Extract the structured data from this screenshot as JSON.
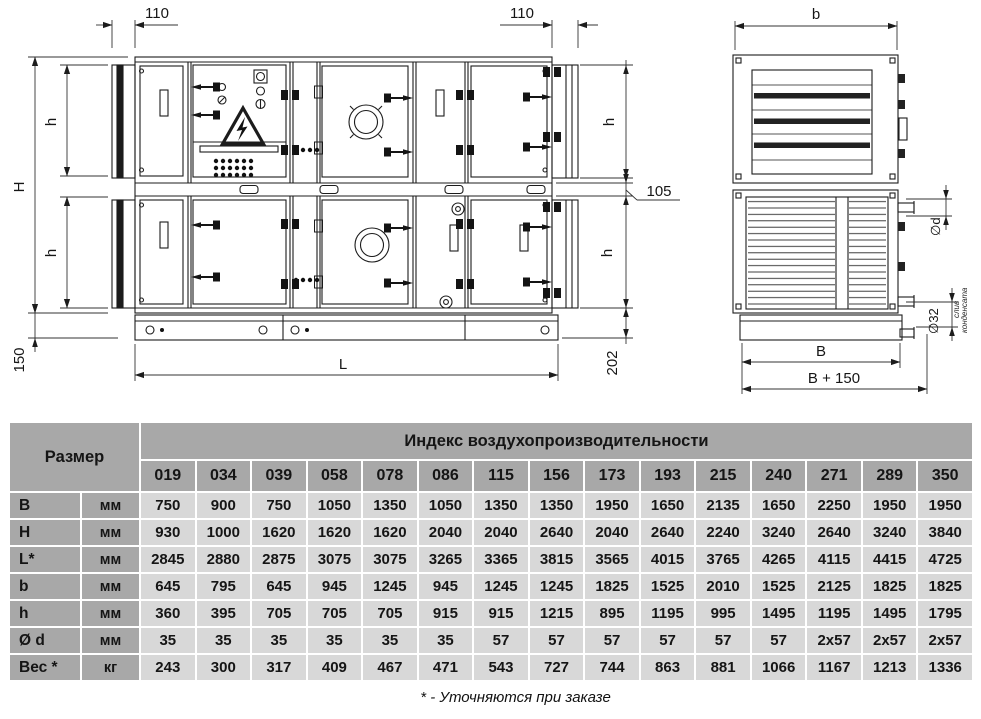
{
  "drawing": {
    "front": {
      "dim_collar_left": "110",
      "dim_collar_right": "110",
      "dim_height": "H",
      "dim_h_upper_left": "h",
      "dim_h_lower_left": "h",
      "dim_h_upper_right": "h",
      "dim_h_lower_right": "h",
      "dim_base_height": "150",
      "dim_length": "L",
      "dim_right_base": "202",
      "dim_mid_frame": "105"
    },
    "side": {
      "dim_top_width": "b",
      "dim_width": "B",
      "dim_width_total": "B + 150",
      "dim_pipe": "∅d",
      "dim_drain": "∅32",
      "drain_caption_line1": "слив",
      "drain_caption_line2": "конденсата"
    }
  },
  "table": {
    "size_header": "Размер",
    "index_header": "Индекс воздухопроизводительности",
    "columns": [
      "019",
      "034",
      "039",
      "058",
      "078",
      "086",
      "115",
      "156",
      "173",
      "193",
      "215",
      "240",
      "271",
      "289",
      "350"
    ],
    "rows": [
      {
        "label": "B",
        "unit": "мм",
        "values": [
          "750",
          "900",
          "750",
          "1050",
          "1350",
          "1050",
          "1350",
          "1350",
          "1950",
          "1650",
          "2135",
          "1650",
          "2250",
          "1950",
          "1950"
        ]
      },
      {
        "label": "H",
        "unit": "мм",
        "values": [
          "930",
          "1000",
          "1620",
          "1620",
          "1620",
          "2040",
          "2040",
          "2640",
          "2040",
          "2640",
          "2240",
          "3240",
          "2640",
          "3240",
          "3840"
        ]
      },
      {
        "label": "L*",
        "unit": "мм",
        "values": [
          "2845",
          "2880",
          "2875",
          "3075",
          "3075",
          "3265",
          "3365",
          "3815",
          "3565",
          "4015",
          "3765",
          "4265",
          "4115",
          "4415",
          "4725"
        ]
      },
      {
        "label": "b",
        "unit": "мм",
        "values": [
          "645",
          "795",
          "645",
          "945",
          "1245",
          "945",
          "1245",
          "1245",
          "1825",
          "1525",
          "2010",
          "1525",
          "2125",
          "1825",
          "1825"
        ]
      },
      {
        "label": "h",
        "unit": "мм",
        "values": [
          "360",
          "395",
          "705",
          "705",
          "705",
          "915",
          "915",
          "1215",
          "895",
          "1195",
          "995",
          "1495",
          "1195",
          "1495",
          "1795"
        ]
      },
      {
        "label": "Ø d",
        "unit": "мм",
        "values": [
          "35",
          "35",
          "35",
          "35",
          "35",
          "35",
          "57",
          "57",
          "57",
          "57",
          "57",
          "57",
          "2x57",
          "2x57",
          "2x57"
        ]
      },
      {
        "label": "Вес *",
        "unit": "кг",
        "values": [
          "243",
          "300",
          "317",
          "409",
          "467",
          "471",
          "543",
          "727",
          "744",
          "863",
          "881",
          "1066",
          "1167",
          "1213",
          "1336"
        ]
      }
    ],
    "footnote": "* - Уточняются при заказе"
  },
  "colors": {
    "header_bg": "#a8a8a8",
    "cell_bg": "#d8d8d8",
    "line": "#1c1c1c"
  }
}
